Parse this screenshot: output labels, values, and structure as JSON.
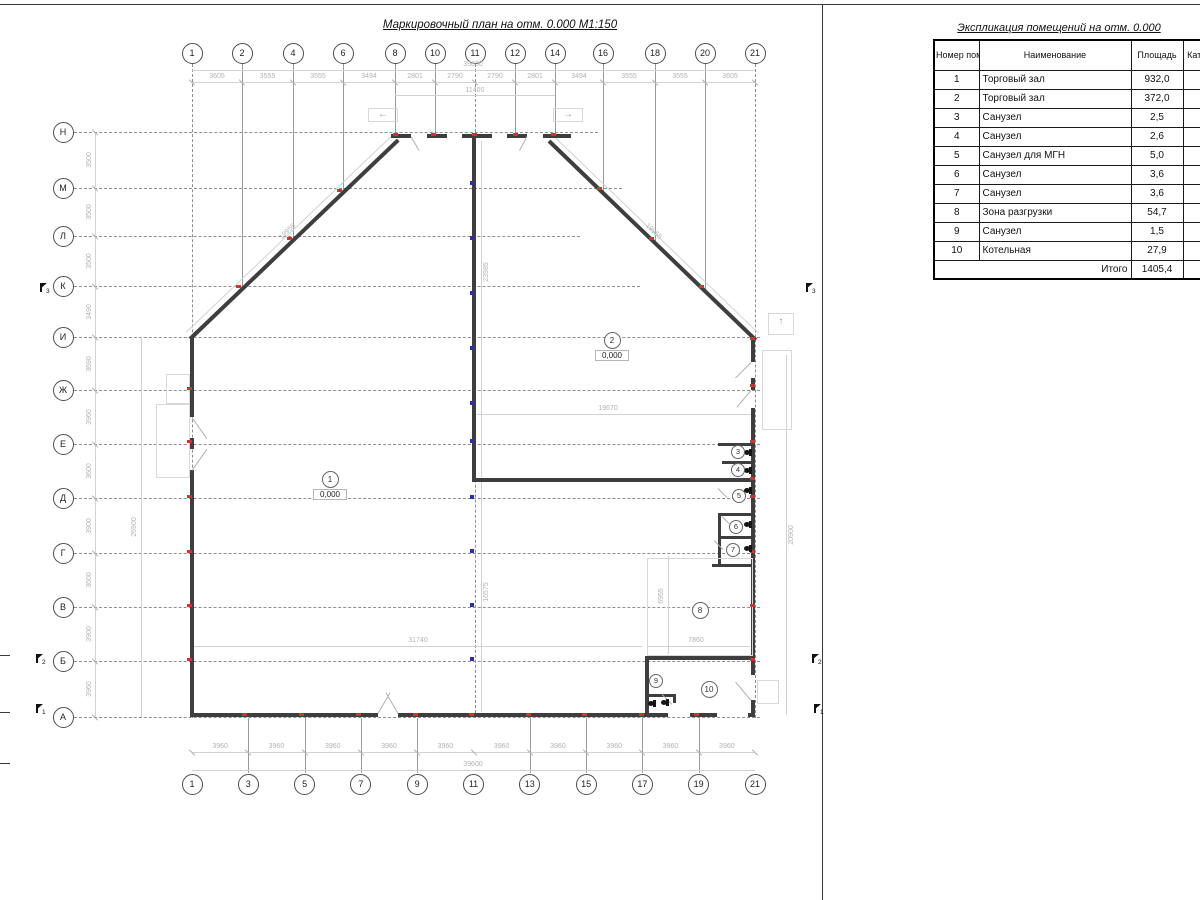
{
  "sheet": {
    "plan_title": "Маркировочный план на отм. 0.000 М1:150",
    "table_title": "Экспликация помещений на отм. 0.000"
  },
  "table": {
    "headers": {
      "number": "Номер помещ.",
      "name": "Наименование",
      "area": "Площадь",
      "category": "Кат. пом"
    },
    "rows": [
      {
        "number": "1",
        "name": "Торговый зал",
        "area": "932,0"
      },
      {
        "number": "2",
        "name": "Торговый зал",
        "area": "372,0"
      },
      {
        "number": "3",
        "name": "Санузел",
        "area": "2,5"
      },
      {
        "number": "4",
        "name": "Санузел",
        "area": "2,6"
      },
      {
        "number": "5",
        "name": "Санузел для МГН",
        "area": "5,0"
      },
      {
        "number": "6",
        "name": "Санузел",
        "area": "3,6"
      },
      {
        "number": "7",
        "name": "Санузел",
        "area": "3,6"
      },
      {
        "number": "8",
        "name": "Зона разгрузки",
        "area": "54,7"
      },
      {
        "number": "9",
        "name": "Санузел",
        "area": "1,5"
      },
      {
        "number": "10",
        "name": "Котельная",
        "area": "27,9"
      }
    ],
    "total_label": "Итого",
    "total_value": "1405,4"
  },
  "plan": {
    "axes_top": [
      "1",
      "2",
      "4",
      "6",
      "8",
      "10",
      "11",
      "12",
      "14",
      "16",
      "18",
      "20",
      "21"
    ],
    "axes_bottom": [
      "1",
      "3",
      "5",
      "7",
      "9",
      "11",
      "13",
      "15",
      "17",
      "19",
      "21"
    ],
    "axes_left": [
      "Н",
      "М",
      "Л",
      "К",
      "И",
      "Ж",
      "Е",
      "Д",
      "Г",
      "В",
      "Б",
      "А"
    ],
    "dims": {
      "top_chain": [
        "3605",
        "3555",
        "3555",
        "3494",
        "2801",
        "2790",
        "2790",
        "2801",
        "3494",
        "3555",
        "3555",
        "3605"
      ],
      "top_total": "39600",
      "top_inner": "11400",
      "bottom_chain": [
        "3960",
        "3960",
        "3960",
        "3960",
        "3960",
        "3960",
        "3960",
        "3960",
        "3960",
        "3960"
      ],
      "bottom_total": "39600",
      "left_chain": [
        "3500",
        "3500",
        "3500",
        "3490",
        "3690",
        "3960",
        "3600",
        "3900",
        "3600",
        "3900",
        "3960"
      ],
      "left_total": "26900",
      "right_total": "20900",
      "hall_width": "19670",
      "hall_height_upper": "23985",
      "hall_height_lower": "16575",
      "room1_width": "31740",
      "room8_width": "7860",
      "room8_height": "6955",
      "slope_left": "19955",
      "slope_right": "19955"
    },
    "rooms": [
      {
        "id": "1",
        "elevation": "0,000"
      },
      {
        "id": "2",
        "elevation": "0,000"
      },
      {
        "id": "3"
      },
      {
        "id": "4"
      },
      {
        "id": "5"
      },
      {
        "id": "6"
      },
      {
        "id": "7"
      },
      {
        "id": "8"
      },
      {
        "id": "9"
      },
      {
        "id": "10"
      }
    ],
    "section_marks": [
      "3",
      "2",
      "1"
    ],
    "arrow_icons": {
      "left": "←",
      "right": "→",
      "up": "↑"
    }
  }
}
